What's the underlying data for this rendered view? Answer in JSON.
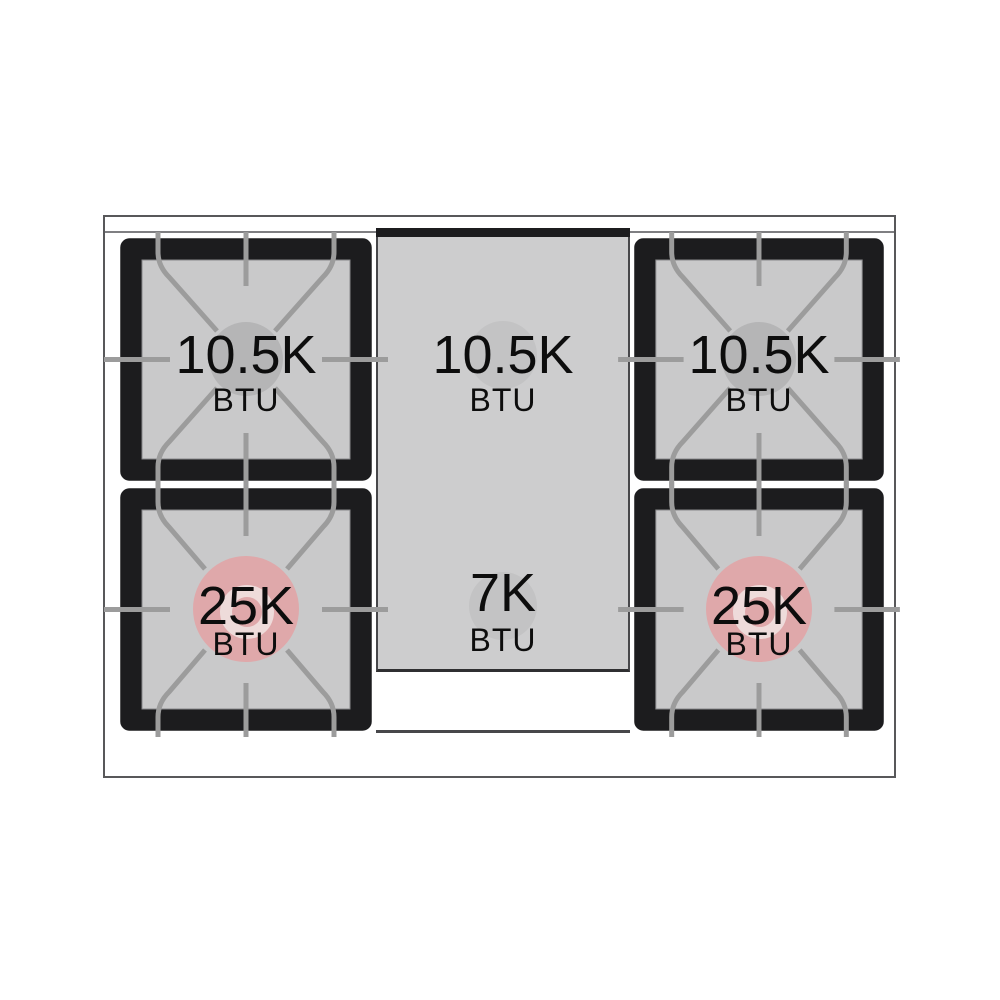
{
  "diagram_title": "Gas range cooktop burner power diagram",
  "burners": [
    {
      "position": "rear-left",
      "btu": "10.5K",
      "unit": "BTU",
      "cap_color": "#b5b5b6"
    },
    {
      "position": "center-rear",
      "btu": "10.5K",
      "unit": "BTU",
      "cap_color": "#c3c3c4"
    },
    {
      "position": "rear-right",
      "btu": "10.5K",
      "unit": "BTU",
      "cap_color": "#b5b5b6"
    },
    {
      "position": "front-left",
      "btu": "25K",
      "unit": "BTU",
      "cap_color": "#dfa8aa",
      "ring_color": "#eedbda",
      "dot_color": "#dfa8aa"
    },
    {
      "position": "center-front",
      "btu": "7K",
      "unit": "BTU",
      "cap_color": "#c3c3c4"
    },
    {
      "position": "front-right",
      "btu": "25K",
      "unit": "BTU",
      "cap_color": "#dfa8aa",
      "ring_color": "#eedbda",
      "dot_color": "#dfa8aa"
    }
  ],
  "colors": {
    "background": "#ffffff",
    "range_outline": "#58585a",
    "grate_black": "#1c1c1e",
    "grate_surface": "#c9c9ca",
    "grate_lines": "#9c9c9c",
    "griddle_gray": "#cdcdce",
    "high_power_accent": "#dfa8aa",
    "text": "#0d0d0d"
  }
}
